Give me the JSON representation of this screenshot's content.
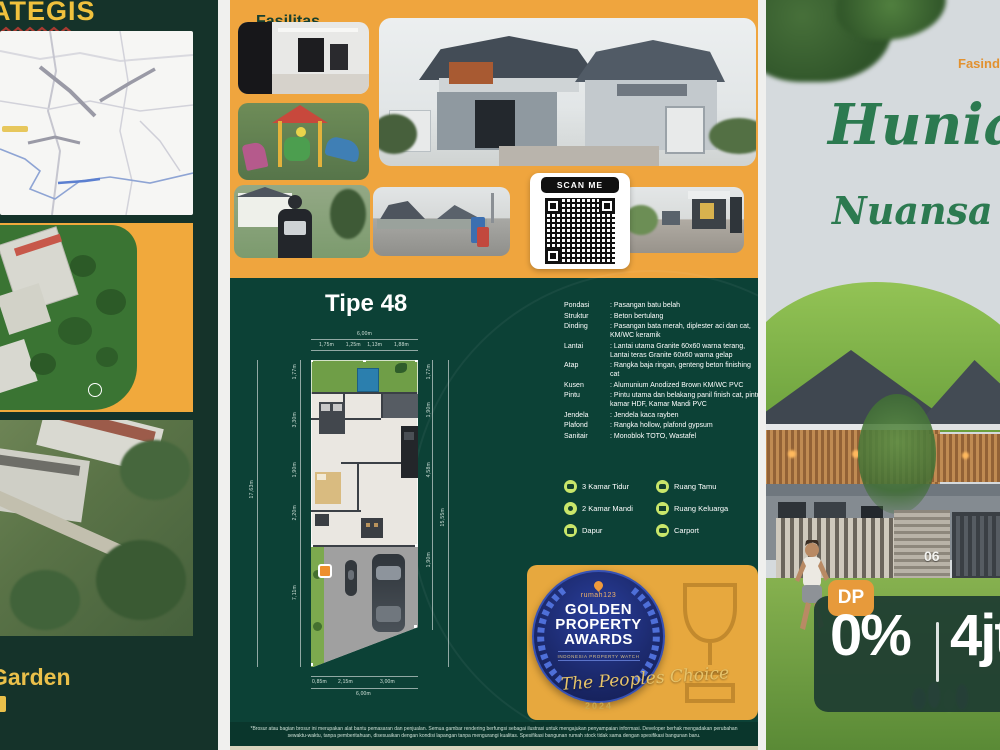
{
  "colors": {
    "panel_green": "#13302a",
    "teal": "#0c4136",
    "orange": "#efa53e",
    "accent_yellow": "#f0c13d",
    "badge_navy": "#1c2a6e",
    "script_green": "#2c7a50",
    "amenity_chip": "#c9e66a"
  },
  "left": {
    "title": "STRATEGIS",
    "footer_brand": "Garden"
  },
  "middle": {
    "facilities_label": "Fasilitas",
    "scan_me": "SCAN ME",
    "type_title": "Tipe 48",
    "floorplan": {
      "top_total": "6,00m",
      "top_segments": [
        "1,75m",
        "1,25m",
        "1,13m",
        "1,88m"
      ],
      "left_total": "17,63m",
      "left_segments": [
        "1,77m",
        "3,30m",
        "1,90m",
        "2,20m",
        "7,11m"
      ],
      "right_segments": [
        "1,77m",
        "1,90m",
        "4,58m",
        "1,90m"
      ],
      "right_total": "15,55m",
      "bottom_segments": [
        "0,85m",
        "2,15m",
        "3,00m"
      ],
      "bottom_total": "6,00m"
    },
    "specs": [
      {
        "label": "Pondasi",
        "value": ": Pasangan batu belah"
      },
      {
        "label": "Struktur",
        "value": ": Beton bertulang"
      },
      {
        "label": "Dinding",
        "value": ": Pasangan bata merah, diplester aci dan cat, KM/WC keramik"
      },
      {
        "label": "Lantai",
        "value": ": Lantai utama Granite 60x60 warna terang, Lantai teras Granite 60x60 warna gelap"
      },
      {
        "label": "Atap",
        "value": ": Rangka baja ringan, genteng beton finishing cat"
      },
      {
        "label": "Kusen",
        "value": ": Alumunium Anodized Brown KM/WC PVC"
      },
      {
        "label": "Pintu",
        "value": ": Pintu utama dan belakang panil finish cat, pintu kamar HDF, Kamar Mandi PVC"
      },
      {
        "label": "Jendela",
        "value": ": Jendela kaca rayben"
      },
      {
        "label": "Plafond",
        "value": ": Rangka hollow, plafond gypsum"
      },
      {
        "label": "Sanitair",
        "value": ": Monoblok TOTO, Wastafel"
      }
    ],
    "amenities_left": [
      {
        "icon": "bed-icon",
        "label": "3 Kamar Tidur"
      },
      {
        "icon": "shower-icon",
        "label": "2 Kamar Mandi"
      },
      {
        "icon": "kitchen-icon",
        "label": "Dapur"
      }
    ],
    "amenities_right": [
      {
        "icon": "sofa-icon",
        "label": "Ruang Tamu"
      },
      {
        "icon": "tv-icon",
        "label": "Ruang Keluarga"
      },
      {
        "icon": "car-icon",
        "label": "Carport"
      }
    ],
    "award": {
      "brand": "rumah123",
      "title_line1": "GOLDEN",
      "title_line2": "PROPERTY",
      "title_line3": "AWARDS",
      "subtitle": "INDONESIA PROPERTY WATCH",
      "tagline": "The Peoples Choice",
      "year": "2024"
    },
    "disclaimer": "*Brosur atau bagian brosur ini merupakan alat bantu pemasaran dan penjualan. Semua gambar rendering berfungsi sebagai ilustrasi untuk mengajukan penyampaian informasi. Developer berhak mengadakan perubahan sewaktu-waktu, tanpa pemberitahuan, disesuaikan dengan kondisi lapangan tanpa mengurangi kualitas. Spesifikasi bangunan rumah stock tidak sama dengan spesifikasi bangunan baru."
  },
  "right": {
    "brand": "Fasind",
    "headline_line1": "Hunian",
    "headline_line2": "Nuansa",
    "house_number": "06",
    "dp_badge": "DP",
    "dp_value": "0%",
    "installment_value": "4jt"
  }
}
